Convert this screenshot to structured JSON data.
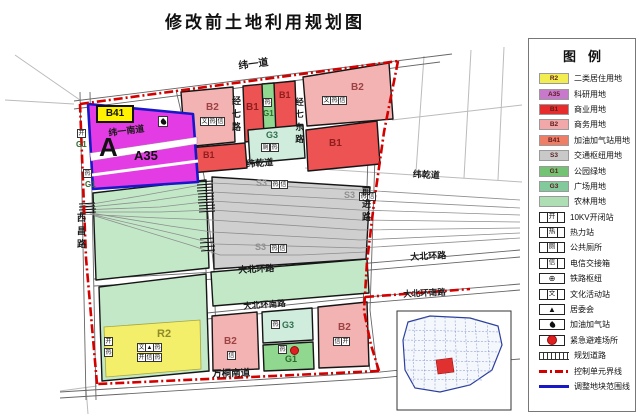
{
  "page": {
    "title": "修改前土地利用规划图"
  },
  "legend": {
    "title": "图例",
    "items": [
      {
        "kind": "swatch",
        "code": "R2",
        "label": "二类居住用地",
        "color": "#F2EE52"
      },
      {
        "kind": "swatch",
        "code": "A35",
        "label": "科研用地",
        "color": "#C879CB"
      },
      {
        "kind": "swatch",
        "code": "B1",
        "label": "商业用地",
        "color": "#E62C2C"
      },
      {
        "kind": "swatch",
        "code": "B2",
        "label": "商务用地",
        "color": "#F2A8A8"
      },
      {
        "kind": "swatch",
        "code": "B41",
        "label": "加油加气站用地",
        "color": "#EF7E66"
      },
      {
        "kind": "swatch",
        "code": "S3",
        "label": "交通枢纽用地",
        "color": "#C9C9C9"
      },
      {
        "kind": "swatch",
        "code": "G1",
        "label": "公园绿地",
        "color": "#74C374"
      },
      {
        "kind": "swatch",
        "code": "G3",
        "label": "广场用地",
        "color": "#82C99C"
      },
      {
        "kind": "swatch",
        "code": "",
        "label": "农林用地",
        "color": "#AEDFB4"
      },
      {
        "kind": "icon",
        "glyph": "开",
        "label": "10KV开闭站"
      },
      {
        "kind": "icon",
        "glyph": "热",
        "label": "热力站"
      },
      {
        "kind": "icon",
        "glyph": "厕",
        "label": "公共厕所"
      },
      {
        "kind": "icon",
        "glyph": "信",
        "label": "电信交接箱"
      },
      {
        "kind": "icon-wheel",
        "glyph": "⊕",
        "label": "铁路枢纽"
      },
      {
        "kind": "icon",
        "glyph": "文",
        "label": "文化活动站"
      },
      {
        "kind": "icon",
        "glyph": "▲",
        "label": "居委会"
      },
      {
        "kind": "icon-flame",
        "label": "加油加气站"
      },
      {
        "kind": "icon-dot",
        "label": "紧急避难场所"
      },
      {
        "kind": "line-hatch",
        "label": "规划道路"
      },
      {
        "kind": "line-reddash",
        "label": "控制单元界线"
      },
      {
        "kind": "line-blue",
        "label": "调整地块范围线"
      }
    ]
  },
  "map": {
    "codes": {
      "b41": "B41",
      "a": "A",
      "a35": "A35",
      "g1": "G1",
      "b1": "B1",
      "b2": "B2",
      "g3": "G3",
      "s3": "S3",
      "r2": "R2"
    },
    "roads": {
      "wei_yi_dao": "纬一道",
      "wei_yi_nan_dao": "纬一南道",
      "xi_chang_lu": "西昌路",
      "jing_qi_lu": "经七路",
      "jing_qi_dong_lu": "经七东路",
      "wei_qian_dao": "纬乾道",
      "da_bei_huan_lu": "大北环路",
      "da_bei_huan_nan_lu": "大北环南路",
      "wan_tong_nan_dao": "万桐南道",
      "qian_jin_lu": "前进路"
    },
    "icon_glyphs": {
      "re": "热",
      "kai": "开",
      "xin": "信",
      "wen": "文",
      "ce": "厕",
      "ju": "▲"
    },
    "colors": {
      "residential": "#F3EF6B",
      "research": "#E43CE4",
      "commercial": "#ED5353",
      "business": "#F4B3B3",
      "transport_hub": "#CFCFCF",
      "park": "#90D890",
      "plaza": "#CFECDD",
      "farm": "#C2E8C8",
      "boundary_red": "#D40000",
      "adjust_blue": "#1818C8"
    }
  }
}
